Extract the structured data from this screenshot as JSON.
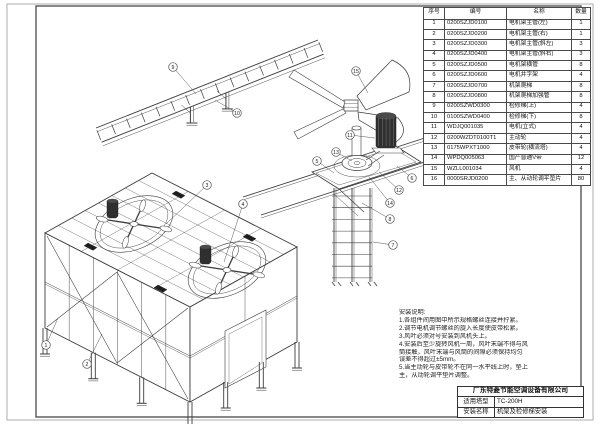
{
  "colors": {
    "ink": "#3c3c3c",
    "paper": "#ffffff",
    "frame": "#555555"
  },
  "parts_table": {
    "headers": [
      "序号",
      "编号",
      "名称",
      "数量"
    ],
    "rows": [
      {
        "no": "1",
        "code": "0200SZJD0100",
        "name": "电机架主管(左)",
        "qty": "1"
      },
      {
        "no": "2",
        "code": "0200SZJD0200",
        "name": "电机架主管(右)",
        "qty": "1"
      },
      {
        "no": "3",
        "code": "0200SZJD0300",
        "name": "电机架主管(斜左)",
        "qty": "3"
      },
      {
        "no": "4",
        "code": "0200SZJD0400",
        "name": "电机架主管(斜右)",
        "qty": "3"
      },
      {
        "no": "5",
        "code": "0200SZJD0500",
        "name": "电机架横管",
        "qty": "8"
      },
      {
        "no": "6",
        "code": "0200SZJD0600",
        "name": "电机井字架",
        "qty": "4"
      },
      {
        "no": "7",
        "code": "0200SZJD0700",
        "name": "机架爬梯",
        "qty": "8"
      },
      {
        "no": "8",
        "code": "0200SZJD0800",
        "name": "机架爬梯加强管",
        "qty": "8"
      },
      {
        "no": "9",
        "code": "0200SZWD0300",
        "name": "检修梯(上)",
        "qty": "4"
      },
      {
        "no": "10",
        "code": "0100SZWD0400",
        "name": "检修梯(下)",
        "qty": "8"
      },
      {
        "no": "11",
        "code": "WDJQ001035",
        "name": "电机(立式)",
        "qty": "4"
      },
      {
        "no": "12",
        "code": "0200WZDT0100T1",
        "name": "主动轮",
        "qty": "4"
      },
      {
        "no": "13",
        "code": "0175WPXT1000",
        "name": "皮带轮(横流塔)",
        "qty": "4"
      },
      {
        "no": "14",
        "code": "WPDQ005063",
        "name": "国产普通V带",
        "qty": "12"
      },
      {
        "no": "15",
        "code": "WZLL001034",
        "name": "风机",
        "qty": "4"
      },
      {
        "no": "16",
        "code": "0000SRJD0200",
        "name": "主、从动轮调平垫片",
        "qty": "80"
      }
    ]
  },
  "notes": {
    "title": "安装说明:",
    "lines": [
      "1.各组件间用图中所示规格螺丝连接并拧紧。",
      "2.调节电机调节螺丝的旋入长度使皮带松紧。",
      "3.风叶必须对号安装到风机头上。",
      "4.安装后至少旋转风机一周，风叶末端不得与风",
      "筒接触，风叶末端与风筒的间隙必须保持均匀",
      "误差不得超过±5mm。",
      "5.当主动轮与皮带轮不在同一水平线上时，垫上",
      "主，从动轮调平垫片调整。"
    ]
  },
  "title_block": {
    "company": "广东特菱节能空调设备有限公司",
    "model_label": "适用塔型",
    "model_value": "TC-200H",
    "install_label": "安装名称",
    "install_value": "机架及检修梯安装"
  },
  "callouts": [
    "1",
    "2",
    "3",
    "4",
    "5",
    "6",
    "7",
    "8",
    "9",
    "10",
    "11",
    "12",
    "13",
    "14",
    "15"
  ]
}
